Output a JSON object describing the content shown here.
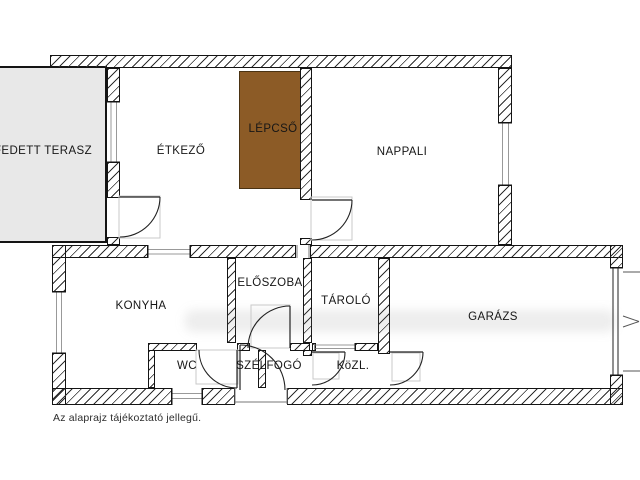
{
  "plan": {
    "rooms": [
      {
        "id": "fedett-terasz",
        "label": "FEDETT TERASZ"
      },
      {
        "id": "etkezo",
        "label": "ÉTKEZŐ"
      },
      {
        "id": "lepcso",
        "label": "LÉPCSŐ"
      },
      {
        "id": "nappali",
        "label": "NAPPALI"
      },
      {
        "id": "konyha",
        "label": "KONYHA"
      },
      {
        "id": "eloszoba",
        "label": "ELŐSZOBA"
      },
      {
        "id": "tarolo",
        "label": "TÁROLÓ"
      },
      {
        "id": "garazs",
        "label": "GARÁZS"
      },
      {
        "id": "wc",
        "label": "WC"
      },
      {
        "id": "szelfogo",
        "label": "SZÉLFOGÓ"
      },
      {
        "id": "kozl",
        "label": "KöZL."
      }
    ],
    "caption": "Az alaprajz tájékoztató jellegű.",
    "colors": {
      "stairs_fill": "#8c5b26",
      "terrace_fill": "#e8e8e8",
      "wall_line": "#141414",
      "door_block_gray": "#c9c9c9"
    }
  }
}
